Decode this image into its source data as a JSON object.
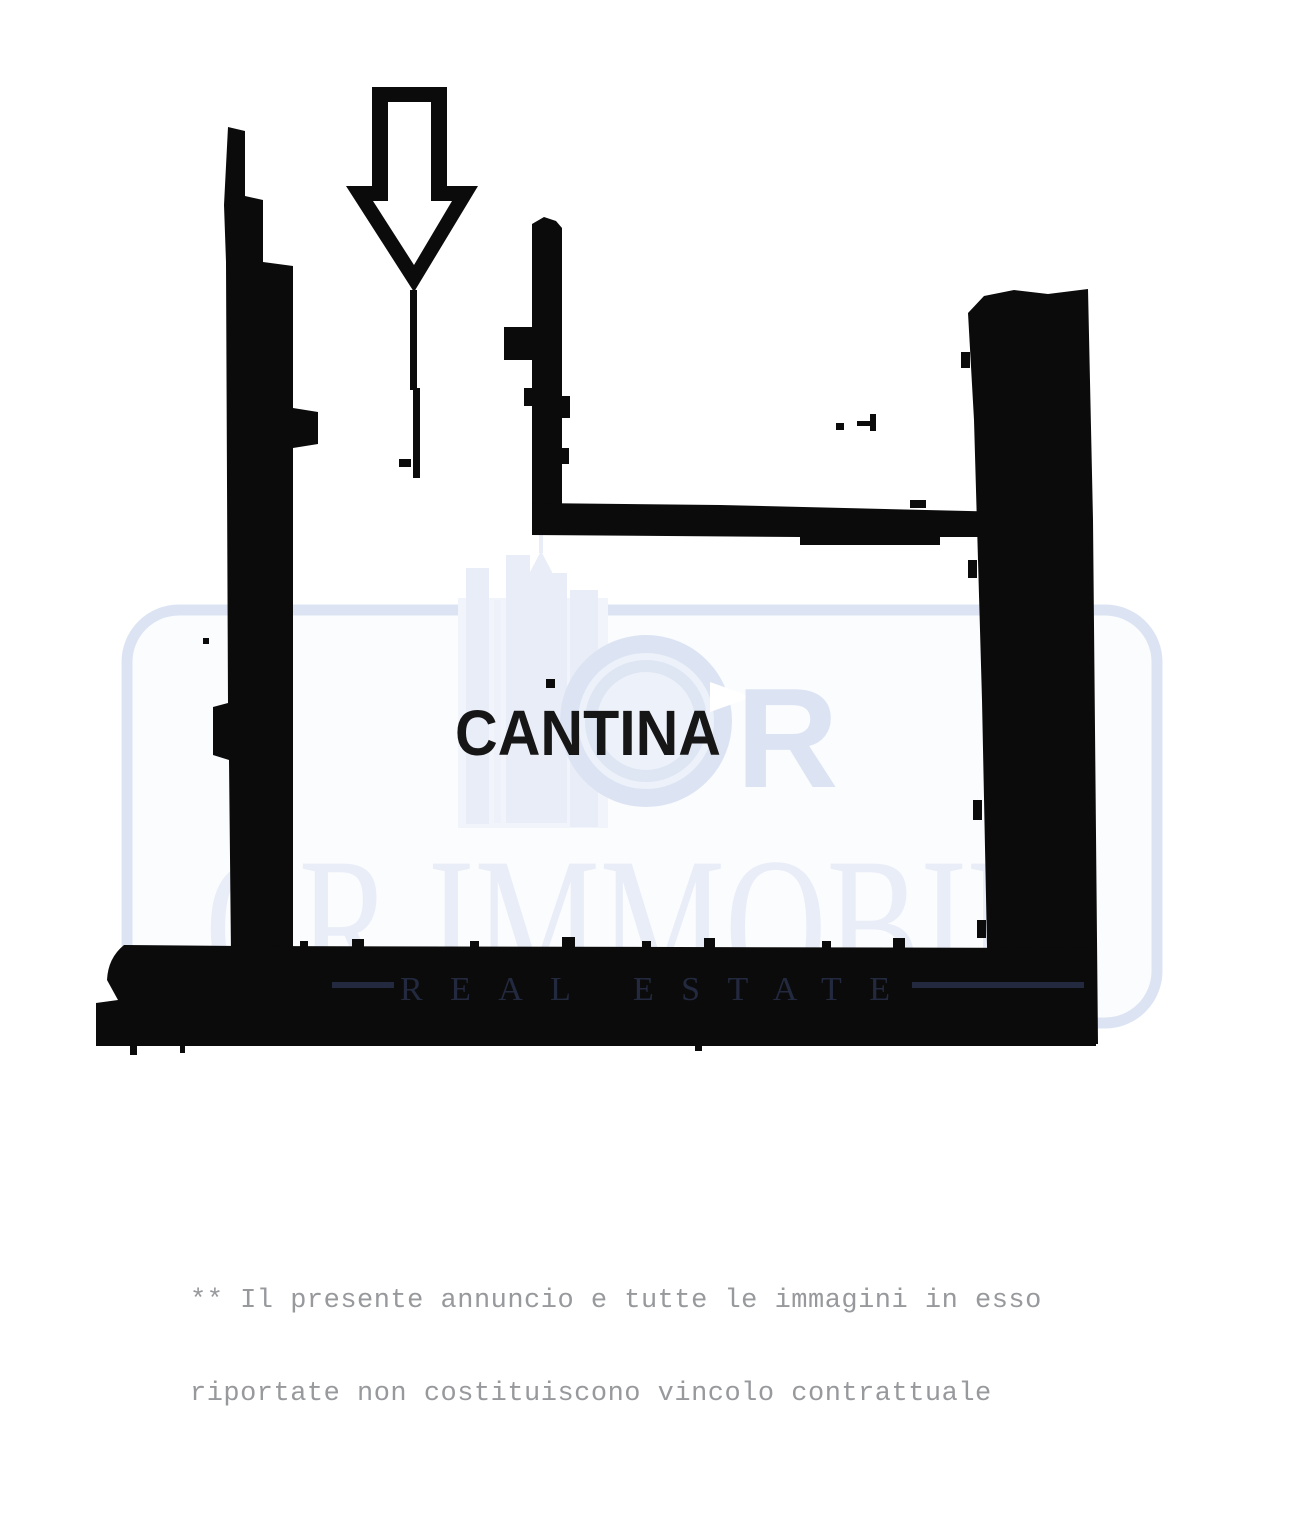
{
  "page": {
    "background_color": "#ffffff"
  },
  "floor_plan": {
    "room_label": "CANTINA",
    "room_label_color": "#161616",
    "wall_color": "#0b0b0b",
    "entrance_icon": "down-arrow-icon"
  },
  "watermark": {
    "brand": "CR IMMOBILI",
    "tagline": "REAL ESTATE",
    "accent_color": "#dce4f4",
    "logo_light_color": "#e9edf7",
    "monogram_letter": "R",
    "tagline_color": "#232a40"
  },
  "disclaimer": {
    "line1": "** Il presente annuncio e tutte le immagini in esso",
    "line2": "riportate non costituiscono vincolo contrattuale",
    "color": "#97999c"
  }
}
